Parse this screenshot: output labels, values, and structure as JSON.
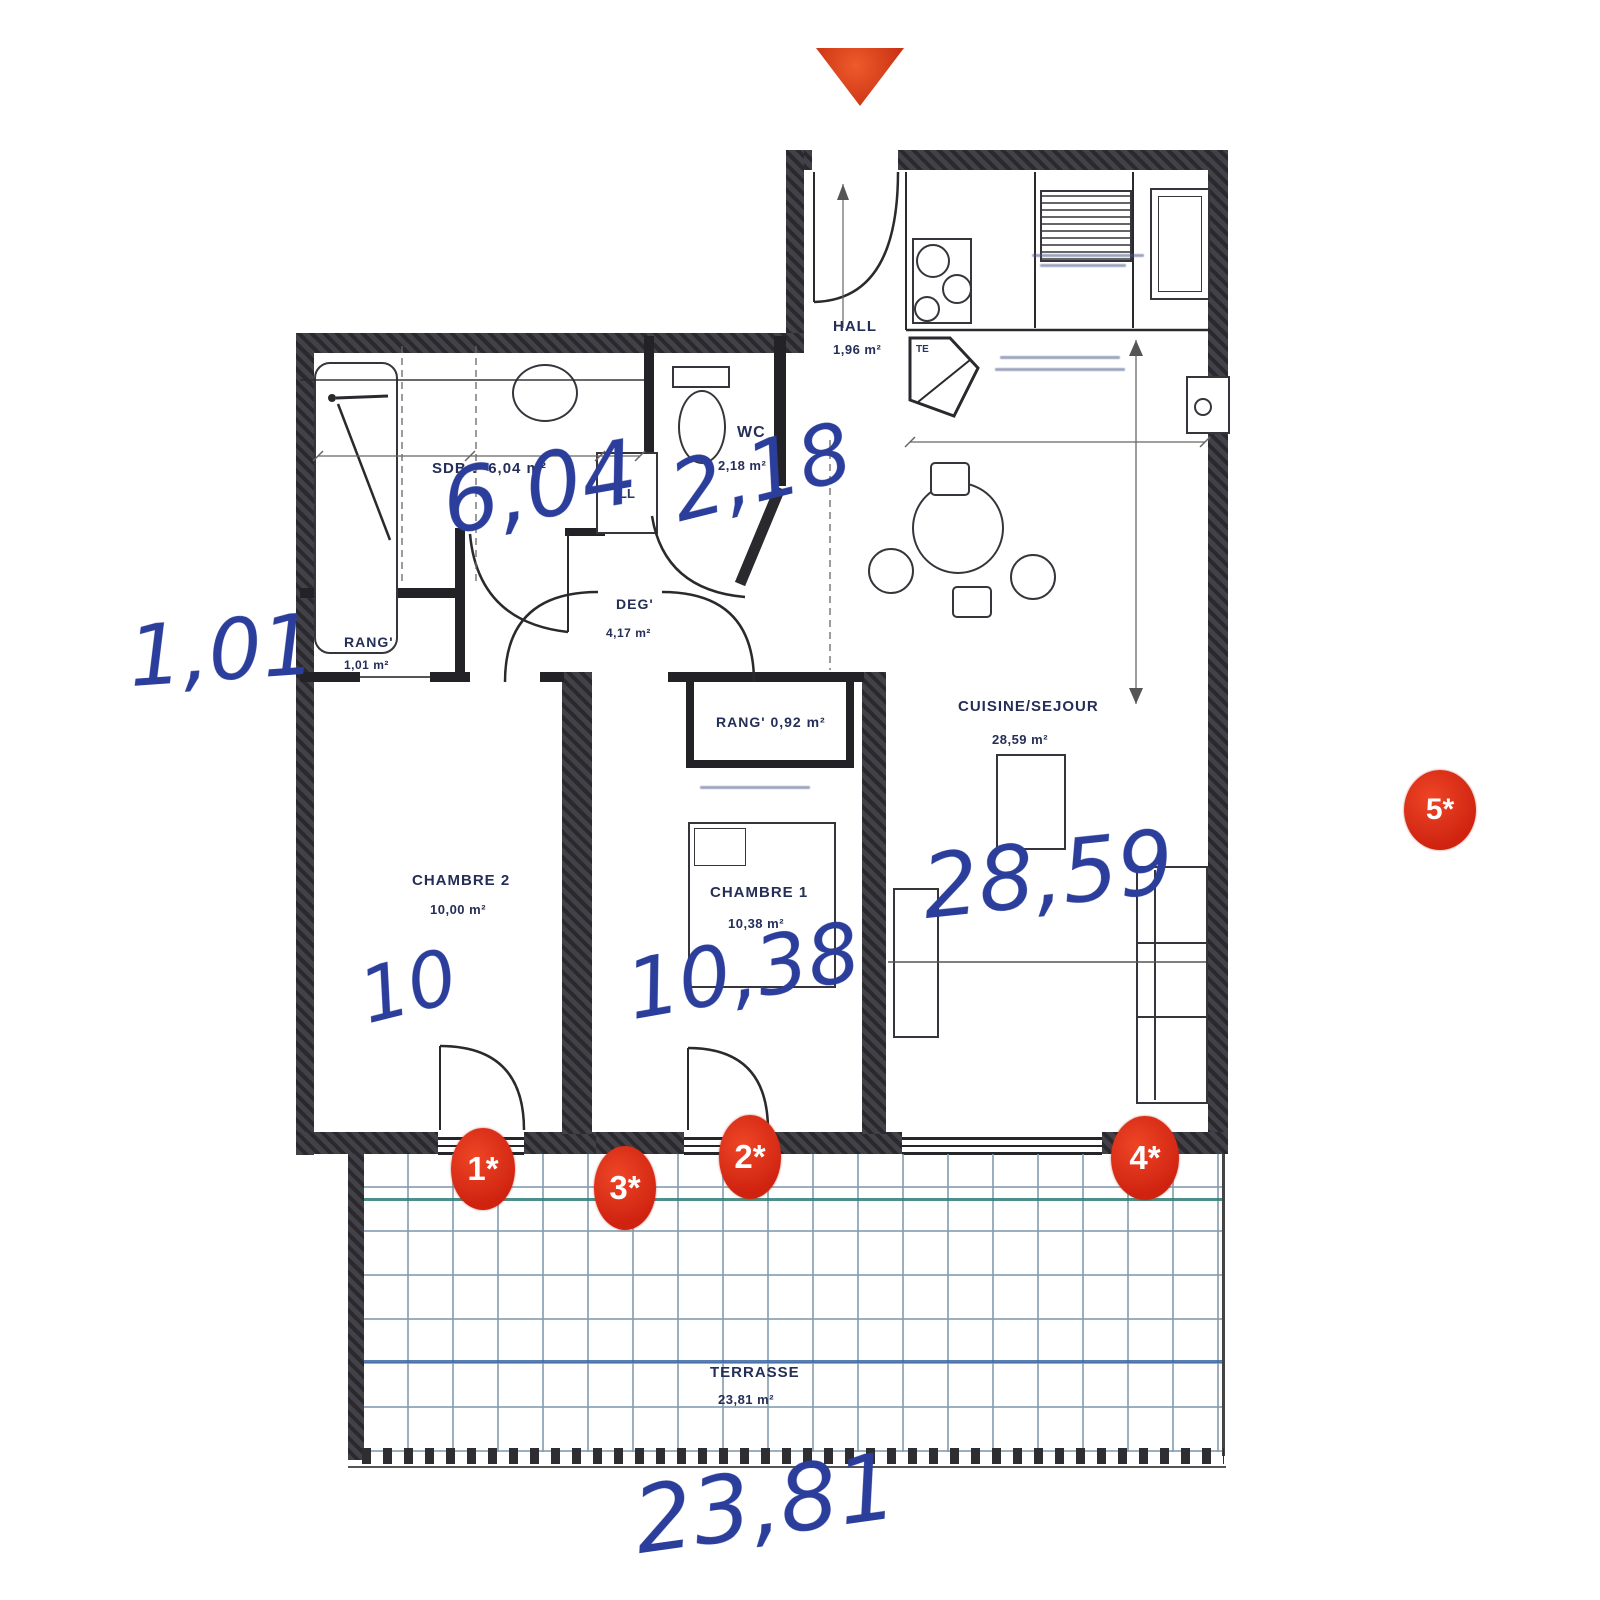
{
  "rooms": [
    {
      "id": "sdb",
      "name": "SDB :",
      "area": "6,04 m²"
    },
    {
      "id": "wc",
      "name": "WC",
      "area": "2,18 m²"
    },
    {
      "id": "hall",
      "name": "HALL",
      "area": "1,96 m²"
    },
    {
      "id": "rang1",
      "name": "RANG'",
      "area": "1,01 m²"
    },
    {
      "id": "deg",
      "name": "DEG'",
      "area": "4,17 m²"
    },
    {
      "id": "rang2",
      "name": "RANG'",
      "area": "0,92 m²"
    },
    {
      "id": "chambre2",
      "name": "CHAMBRE 2",
      "area": "10,00 m²"
    },
    {
      "id": "chambre1",
      "name": "CHAMBRE 1",
      "area": "10,38 m²"
    },
    {
      "id": "cuisine_sejour",
      "name": "CUISINE/SEJOUR",
      "area": "28,59 m²"
    },
    {
      "id": "terrasse",
      "name": "TERRASSE",
      "area": "23,81 m²"
    }
  ],
  "fixtures": {
    "washing_machine": "LL",
    "closet": "TE"
  },
  "handwritten": {
    "rang_left": "1,01",
    "sdb": "6,04",
    "wc": "2,18",
    "chambre2": "10",
    "chambre1": "10,38",
    "sejour": "28,59",
    "terrasse": "23,81"
  },
  "markers": [
    {
      "label": "1*"
    },
    {
      "label": "2*"
    },
    {
      "label": "3*"
    },
    {
      "label": "4*"
    },
    {
      "label": "5*"
    }
  ],
  "colors": {
    "handwriting_blue": "#2c3e9c",
    "marker_red": "#d42a12",
    "print_navy": "#252e56",
    "wall_dark": "#2a292d",
    "terrace_grid": "#8ba3b5",
    "north_arrow": "#d8401c"
  }
}
